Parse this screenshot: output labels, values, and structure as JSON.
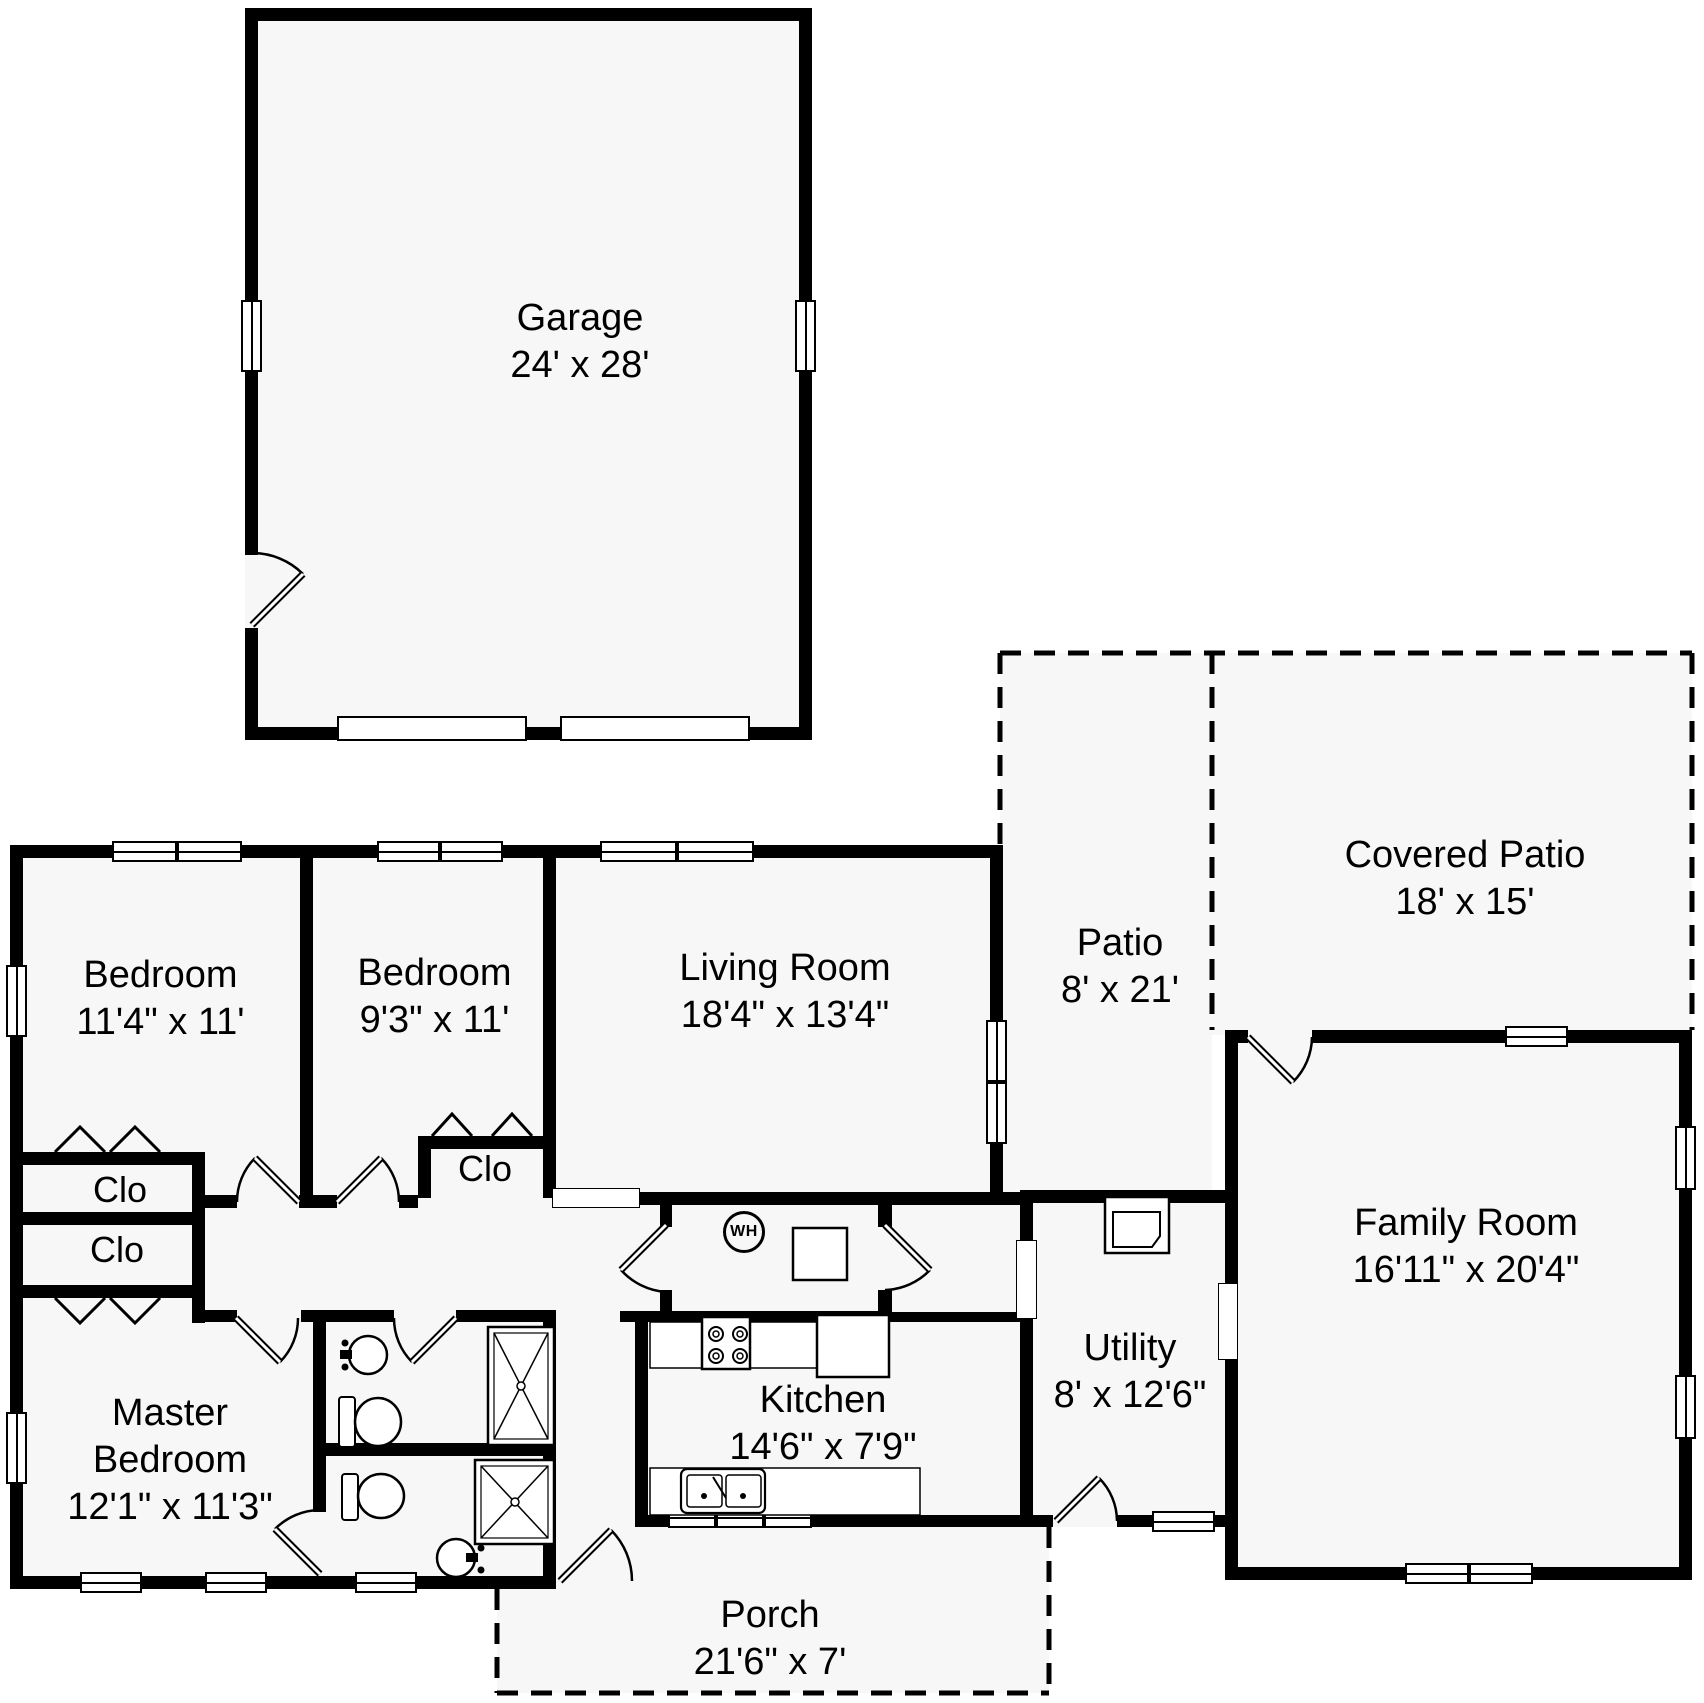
{
  "plan_title": "House Floor Plan",
  "colors": {
    "wall": "#000000",
    "floor": "#f7f7f7",
    "background": "#ffffff"
  },
  "rooms": {
    "garage": {
      "name": "Garage",
      "dims": "24' x 28'"
    },
    "bedroom_1": {
      "name": "Bedroom",
      "dims": "11'4\" x 11'"
    },
    "bedroom_2": {
      "name": "Bedroom",
      "dims": "9'3\" x 11'"
    },
    "living_room": {
      "name": "Living Room",
      "dims": "18'4\" x 13'4\""
    },
    "family_room": {
      "name": "Family Room",
      "dims": "16'11\" x 20'4\""
    },
    "master_bedroom": {
      "name": "Master Bedroom",
      "dims": "12'1\" x 11'3\""
    },
    "kitchen": {
      "name": "Kitchen",
      "dims": "14'6\" x 7'9\""
    },
    "utility": {
      "name": "Utility",
      "dims": "8' x 12'6\""
    },
    "porch": {
      "name": "Porch",
      "dims": "21'6\" x 7'"
    },
    "patio": {
      "name": "Patio",
      "dims": "8' x 21'"
    },
    "covered_patio": {
      "name": "Covered Patio",
      "dims": "18' x 15'"
    }
  },
  "closets": {
    "closet_bedroom1": "Clo",
    "closet_master": "Clo",
    "closet_bedroom2": "Clo"
  },
  "fixtures": {
    "water_heater": "WH"
  }
}
